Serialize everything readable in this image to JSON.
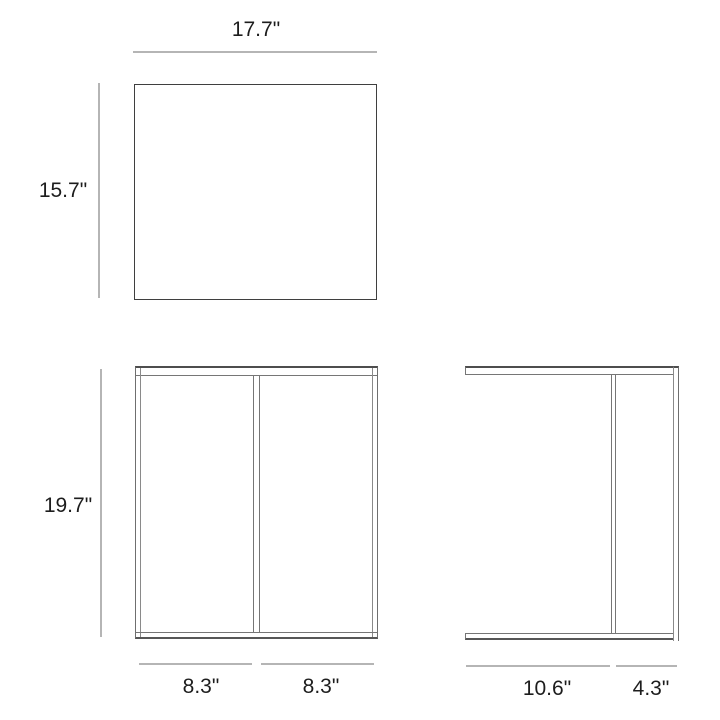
{
  "diagram": {
    "kind": "furniture-dimension-drawing",
    "units": "inches",
    "views": {
      "top": {
        "width": "17.7\"",
        "depth": "15.7\""
      },
      "front": {
        "height": "19.7\"",
        "span_left": "8.3\"",
        "span_right": "8.3\""
      },
      "side": {
        "depth_open": "10.6\"",
        "depth_back": "4.3\""
      }
    },
    "colors": {
      "outline_dark": "#3f3f3f",
      "outline_mid": "#6f6f6f",
      "outline_light": "#8a8a8a",
      "dim_line": "#b5b5b5",
      "label_text": "#1d1d1d",
      "background": "#ffffff"
    }
  }
}
